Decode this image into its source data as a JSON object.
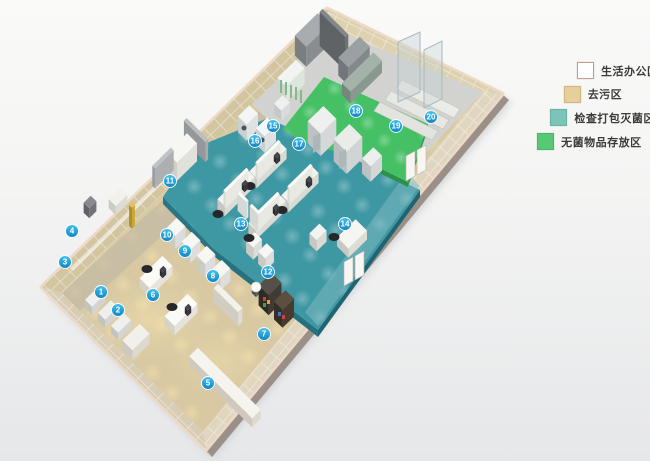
{
  "legend": {
    "items": [
      {
        "label": "生活办公区",
        "color": "#ffffff",
        "border": "#c59e83"
      },
      {
        "label": "去污区",
        "color": "#e6cf9d",
        "border": "#d0b77e"
      },
      {
        "label": "检查打包灭菌区",
        "color": "#7cc4b8",
        "border": "#6ab2a6"
      },
      {
        "label": "无菌物品存放区",
        "color": "#57c873",
        "border": "#48b763"
      }
    ]
  },
  "markers": [
    {
      "n": "1",
      "x": 101,
      "y": 292
    },
    {
      "n": "2",
      "x": 118,
      "y": 310
    },
    {
      "n": "3",
      "x": 65,
      "y": 262
    },
    {
      "n": "4",
      "x": 72,
      "y": 231
    },
    {
      "n": "5",
      "x": 208,
      "y": 383
    },
    {
      "n": "6",
      "x": 153,
      "y": 295
    },
    {
      "n": "7",
      "x": 264,
      "y": 334
    },
    {
      "n": "8",
      "x": 213,
      "y": 276
    },
    {
      "n": "9",
      "x": 185,
      "y": 251
    },
    {
      "n": "10",
      "x": 167,
      "y": 235
    },
    {
      "n": "11",
      "x": 170,
      "y": 181
    },
    {
      "n": "12",
      "x": 268,
      "y": 272
    },
    {
      "n": "13",
      "x": 241,
      "y": 224
    },
    {
      "n": "14",
      "x": 345,
      "y": 224
    },
    {
      "n": "15",
      "x": 273,
      "y": 126
    },
    {
      "n": "16",
      "x": 255,
      "y": 141
    },
    {
      "n": "17",
      "x": 299,
      "y": 144
    },
    {
      "n": "18",
      "x": 356,
      "y": 111
    },
    {
      "n": "19",
      "x": 396,
      "y": 126
    },
    {
      "n": "20",
      "x": 431,
      "y": 117
    }
  ],
  "marker_style": {
    "fill_top": "#45c3f0",
    "fill_bottom": "#0d84c2",
    "ring": "#ffffff"
  },
  "floor_colors": {
    "office_floor": "#d8c9a3",
    "corridor_floor": "#c2bba8",
    "inspection_floor": "#3e98a3",
    "sterile_floor": "#45c065",
    "storage_floor": "#d2d3d0"
  }
}
